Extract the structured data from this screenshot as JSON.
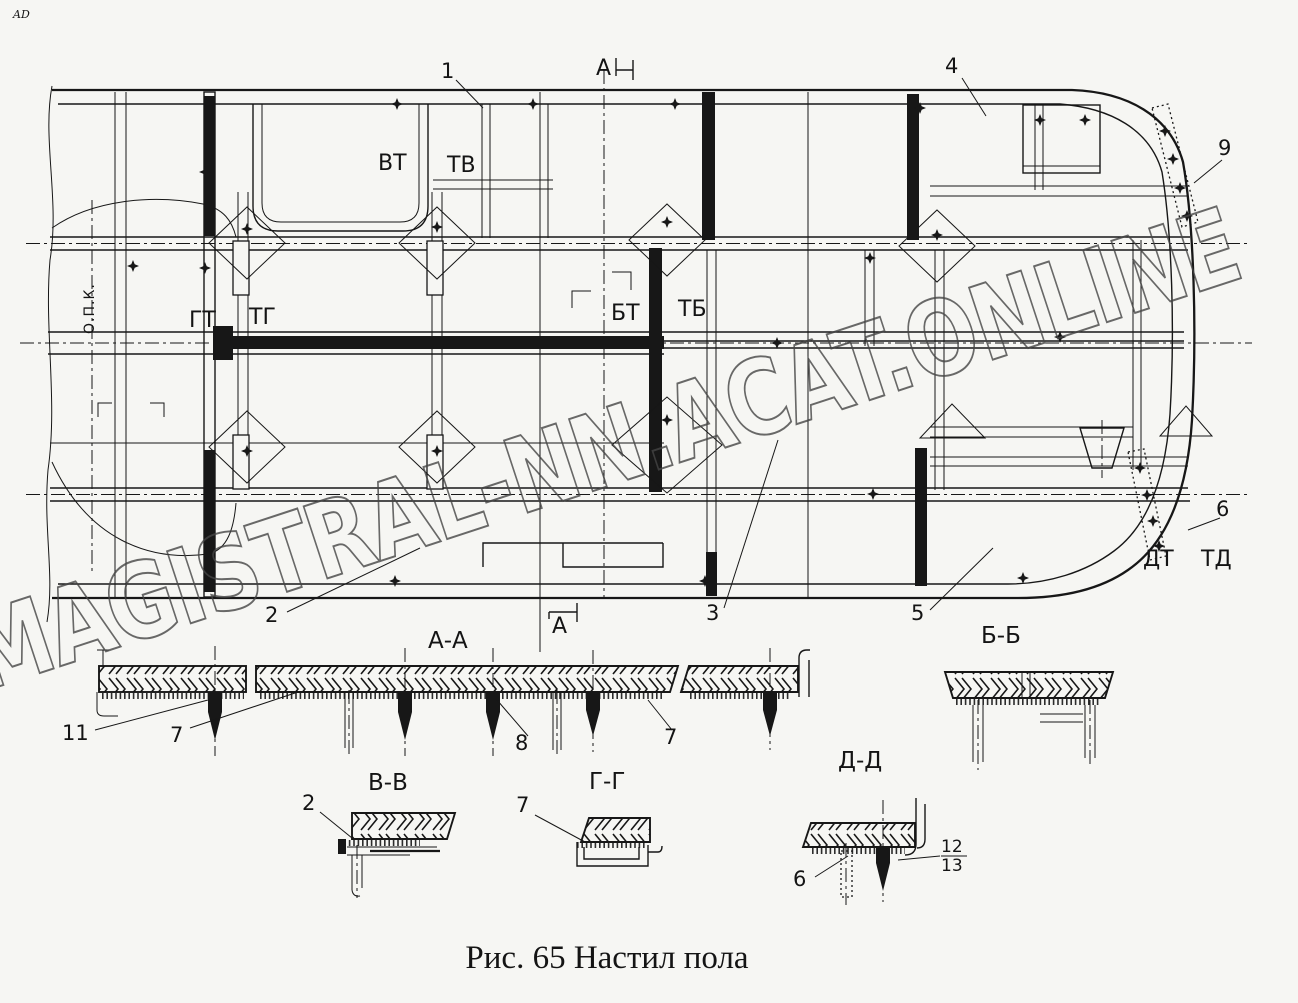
{
  "page": {
    "corner_mark": "AD",
    "watermark": "MAGISTRAL-NN.ACAT.ONLINE",
    "caption": "Рис. 65 Настил пола",
    "paper_color": "#f6f6f3",
    "ink_color": "#171717",
    "watermark_color": "#454545"
  },
  "plan": {
    "opk_label": "О.П.К.",
    "cut_labels": {
      "a_top": "А",
      "a_bottom": "А",
      "v_left": "ВТ",
      "v_right": "ТВ",
      "g_left": "ГТ",
      "g_right": "ТГ",
      "b_left": "БТ",
      "b_right": "ТБ",
      "d_left": "ДТ",
      "d_right": "ТД"
    },
    "callouts": {
      "c1": "1",
      "c2": "2",
      "c3": "3",
      "c4": "4",
      "c5": "5",
      "c6": "6",
      "c9": "9"
    }
  },
  "sections": {
    "aa": {
      "title": "А-А",
      "callout_11": "11",
      "callout_7a": "7",
      "callout_8": "8",
      "callout_7b": "7"
    },
    "bb": {
      "title": "Б-Б"
    },
    "vv": {
      "title": "В-В",
      "callout_2": "2"
    },
    "gg": {
      "title": "Г-Г",
      "callout_7": "7"
    },
    "dd": {
      "title": "Д-Д",
      "callout_6": "6",
      "callout_12": "12",
      "callout_13": "13"
    }
  }
}
